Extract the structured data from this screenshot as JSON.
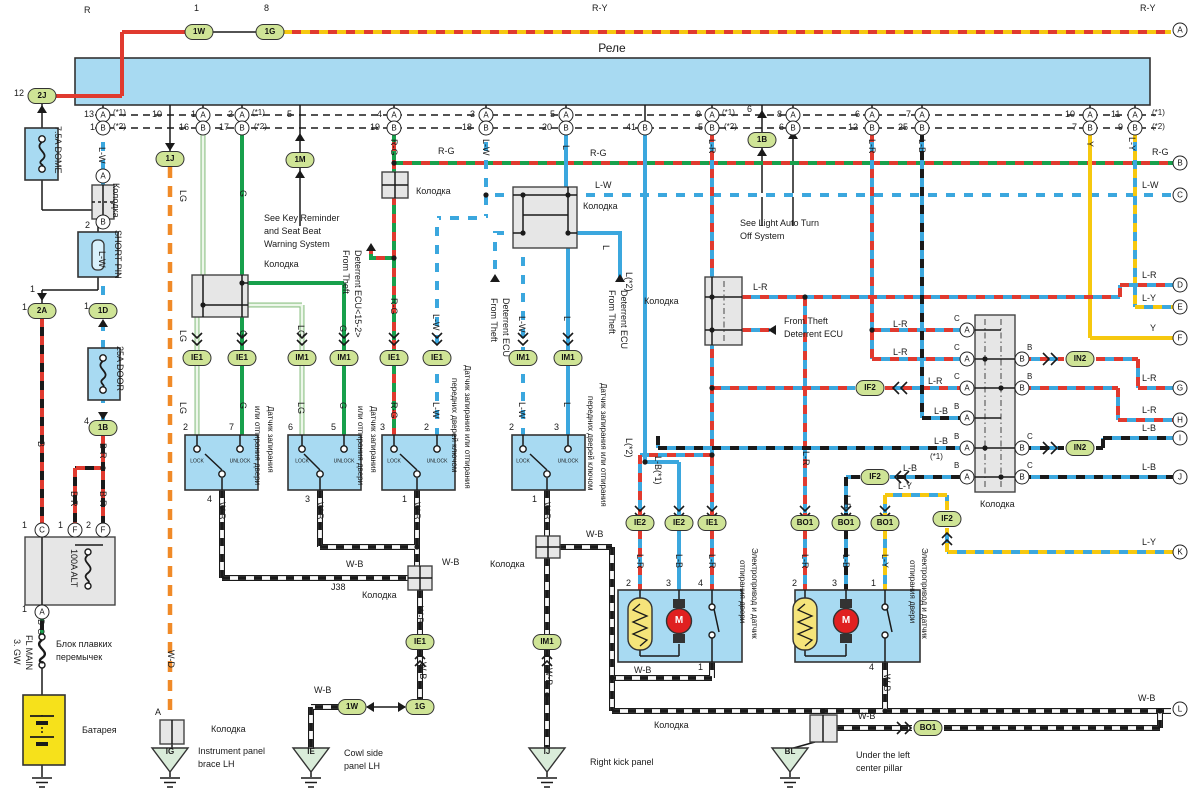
{
  "relay": {
    "label": "Реле"
  },
  "ovals": [
    [
      "2J",
      42,
      96
    ],
    [
      "1W",
      199,
      32
    ],
    [
      "1G",
      270,
      32
    ],
    [
      "1J",
      170,
      159
    ],
    [
      "1M",
      300,
      160
    ],
    [
      "1B",
      762,
      140
    ],
    [
      "2A",
      42,
      311
    ],
    [
      "1D",
      103,
      311
    ],
    [
      "1B",
      103,
      428
    ],
    [
      "IE1",
      197,
      358
    ],
    [
      "IE1",
      242,
      358
    ],
    [
      "IM1",
      302,
      358
    ],
    [
      "IM1",
      344,
      358
    ],
    [
      "IE1",
      394,
      358
    ],
    [
      "IE1",
      437,
      358
    ],
    [
      "IM1",
      523,
      358
    ],
    [
      "IM1",
      568,
      358
    ],
    [
      "IE2",
      640,
      523
    ],
    [
      "IE2",
      679,
      523
    ],
    [
      "IE1",
      712,
      523
    ],
    [
      "BO1",
      805,
      523
    ],
    [
      "BO1",
      846,
      523
    ],
    [
      "BO1",
      885,
      523
    ],
    [
      "IE1",
      420,
      642
    ],
    [
      "IM1",
      547,
      642
    ],
    [
      "1W",
      352,
      707
    ],
    [
      "1G",
      420,
      707
    ],
    [
      "BO1",
      928,
      728
    ],
    [
      "IN2",
      1080,
      359
    ],
    [
      "IN2",
      1080,
      448
    ],
    [
      "IF2",
      875,
      477
    ],
    [
      "IF2",
      947,
      519
    ],
    [
      "IF2",
      870,
      388
    ]
  ],
  "circles": [
    [
      "A",
      103,
      115
    ],
    [
      "A",
      203,
      115
    ],
    [
      "A",
      242,
      115
    ],
    [
      "A",
      394,
      115
    ],
    [
      "A",
      486,
      115
    ],
    [
      "A",
      566,
      115
    ],
    [
      "A",
      712,
      115
    ],
    [
      "A",
      793,
      115
    ],
    [
      "A",
      872,
      115
    ],
    [
      "A",
      922,
      115
    ],
    [
      "A",
      1090,
      115
    ],
    [
      "A",
      1135,
      115
    ],
    [
      "B",
      103,
      128
    ],
    [
      "B",
      203,
      128
    ],
    [
      "B",
      242,
      128
    ],
    [
      "B",
      394,
      128
    ],
    [
      "B",
      486,
      128
    ],
    [
      "B",
      566,
      128
    ],
    [
      "B",
      645,
      128
    ],
    [
      "B",
      712,
      128
    ],
    [
      "B",
      793,
      128
    ],
    [
      "B",
      872,
      128
    ],
    [
      "B",
      922,
      128
    ],
    [
      "B",
      1090,
      128
    ],
    [
      "B",
      1135,
      128
    ],
    [
      "A",
      103,
      176
    ],
    [
      "B",
      103,
      222
    ],
    [
      "C",
      42,
      530
    ],
    [
      "F",
      75,
      530
    ],
    [
      "F",
      103,
      530
    ],
    [
      "A",
      42,
      612
    ],
    [
      "A",
      967,
      330
    ],
    [
      "A",
      967,
      359
    ],
    [
      "A",
      967,
      388
    ],
    [
      "A",
      967,
      418
    ],
    [
      "A",
      967,
      448
    ],
    [
      "A",
      967,
      477
    ],
    [
      "B",
      1022,
      359
    ],
    [
      "B",
      1022,
      388
    ],
    [
      "B",
      1022,
      448
    ],
    [
      "B",
      1022,
      477
    ],
    [
      "A",
      1180,
      30
    ],
    [
      "B",
      1180,
      163
    ],
    [
      "C",
      1180,
      195
    ],
    [
      "D",
      1180,
      285
    ],
    [
      "E",
      1180,
      307
    ],
    [
      "F",
      1180,
      338
    ],
    [
      "G",
      1180,
      388
    ],
    [
      "H",
      1180,
      420
    ],
    [
      "I",
      1180,
      438
    ],
    [
      "J",
      1180,
      477
    ],
    [
      "K",
      1180,
      552
    ],
    [
      "L",
      1180,
      709
    ]
  ],
  "labels": [
    [
      "R",
      84,
      6
    ],
    [
      "1",
      194,
      4
    ],
    [
      "8",
      264,
      4
    ],
    [
      "R-Y",
      592,
      4
    ],
    [
      "R-Y",
      1140,
      4
    ],
    [
      "12",
      14,
      89
    ],
    [
      "(*1)",
      1152,
      109,
      0,
      8
    ],
    [
      "(*2)",
      1152,
      123,
      0,
      8
    ],
    [
      "13",
      84,
      110
    ],
    [
      "(*1)",
      113,
      109,
      0,
      8
    ],
    [
      "1",
      90,
      123
    ],
    [
      "(*2)",
      113,
      123,
      0,
      8
    ],
    [
      "10",
      152,
      110
    ],
    [
      "1",
      191,
      110
    ],
    [
      "16",
      179,
      123
    ],
    [
      "2",
      228,
      110
    ],
    [
      "(*1)",
      252,
      109,
      0,
      8
    ],
    [
      "17",
      219,
      123
    ],
    [
      "(*2)",
      254,
      123,
      0,
      8
    ],
    [
      "5",
      287,
      110
    ],
    [
      "4",
      377,
      110
    ],
    [
      "19",
      370,
      123
    ],
    [
      "3",
      470,
      110
    ],
    [
      "18",
      462,
      123
    ],
    [
      "5",
      550,
      110
    ],
    [
      "20",
      542,
      123
    ],
    [
      "41",
      626,
      123
    ],
    [
      "9",
      696,
      110
    ],
    [
      "(*1)",
      722,
      109,
      0,
      8
    ],
    [
      "5",
      698,
      123
    ],
    [
      "(*2)",
      724,
      123,
      0,
      8
    ],
    [
      "6",
      747,
      105
    ],
    [
      "8",
      777,
      110
    ],
    [
      "6",
      779,
      123
    ],
    [
      "6",
      855,
      110
    ],
    [
      "12",
      848,
      123
    ],
    [
      "7",
      906,
      110
    ],
    [
      "25",
      898,
      123
    ],
    [
      "10",
      1065,
      110
    ],
    [
      "7",
      1072,
      123
    ],
    [
      "11",
      1111,
      110
    ],
    [
      "9",
      1118,
      123
    ],
    [
      "7.5A DOME",
      62,
      126,
      1
    ],
    [
      "2",
      85,
      221
    ],
    [
      "SHORT PIN",
      122,
      230,
      1
    ],
    [
      "1",
      30,
      285
    ],
    [
      "1",
      22,
      303
    ],
    [
      "B",
      45,
      441,
      1
    ],
    [
      "L-W",
      106,
      147,
      1
    ],
    [
      "Колодка",
      120,
      183,
      1
    ],
    [
      "L-W",
      106,
      251,
      1
    ],
    [
      "1",
      84,
      302
    ],
    [
      "25A DOOR",
      124,
      346,
      1
    ],
    [
      "4",
      84,
      417
    ],
    [
      "B-R",
      107,
      443,
      1
    ],
    [
      "B-R",
      78,
      491,
      1
    ],
    [
      "B-R",
      107,
      491,
      1
    ],
    [
      "1",
      22,
      521
    ],
    [
      "1",
      58,
      521
    ],
    [
      "2",
      86,
      521
    ],
    [
      "1",
      22,
      605
    ],
    [
      "100A ALT",
      78,
      549,
      1
    ],
    [
      "B-G",
      45,
      619,
      1
    ],
    [
      "FL MAIN",
      33,
      635,
      1
    ],
    [
      "3. GW",
      21,
      639,
      1
    ],
    [
      "Блок плавких",
      56,
      640
    ],
    [
      "перемычек",
      56,
      653
    ],
    [
      "Батарея",
      82,
      726
    ],
    [
      "LG",
      187,
      190,
      1
    ],
    [
      "G",
      247,
      190,
      1
    ],
    [
      "R-G",
      398,
      139,
      1
    ],
    [
      "L-W",
      490,
      139,
      1
    ],
    [
      "L",
      570,
      145,
      1
    ],
    [
      "L(*2)",
      633,
      272,
      1
    ],
    [
      "L-R",
      716,
      139,
      1
    ],
    [
      "L-R",
      876,
      139,
      1
    ],
    [
      "L-B",
      926,
      139,
      1
    ],
    [
      "Y",
      1094,
      141,
      1
    ],
    [
      "L-Y",
      1136,
      137,
      1
    ],
    [
      "R-G",
      438,
      147
    ],
    [
      "R-G",
      590,
      149
    ],
    [
      "R-G",
      1152,
      148
    ],
    [
      "L-W",
      595,
      181
    ],
    [
      "L-W",
      1142,
      181
    ],
    [
      "L-R",
      753,
      283
    ],
    [
      "L-R",
      1142,
      271
    ],
    [
      "L-Y",
      1142,
      294
    ],
    [
      "Y",
      1150,
      324
    ],
    [
      "W-D",
      175,
      650,
      1
    ],
    [
      "Колодка",
      416,
      187
    ],
    [
      "Колодка",
      264,
      260
    ],
    [
      "Колодка",
      583,
      202
    ],
    [
      "Колодка",
      644,
      297
    ],
    [
      "Колодка",
      362,
      591
    ],
    [
      "Колодка",
      490,
      560
    ],
    [
      "Колодка",
      980,
      500
    ],
    [
      "Колодка",
      211,
      725
    ],
    [
      "Колодка",
      654,
      721
    ],
    [
      "See Key Reminder",
      264,
      214
    ],
    [
      "and Seat Beat",
      264,
      227
    ],
    [
      "Warning System",
      264,
      240
    ],
    [
      "See Light Auto Turn",
      740,
      219
    ],
    [
      "Off System",
      740,
      232
    ],
    [
      "From Theft",
      784,
      317
    ],
    [
      "Deterrent ECU",
      784,
      330
    ],
    [
      "From Theft",
      350,
      250,
      1
    ],
    [
      "Deterrent ECU<15-2>",
      362,
      250,
      1
    ],
    [
      "From Theft",
      498,
      298,
      1
    ],
    [
      "Deterrent ECU",
      510,
      298,
      1
    ],
    [
      "From Theft",
      616,
      290,
      1
    ],
    [
      "Deterrent ECU",
      628,
      290,
      1
    ],
    [
      "LG",
      187,
      330,
      1
    ],
    [
      "G",
      247,
      330,
      1
    ],
    [
      "LG",
      305,
      325,
      1
    ],
    [
      "G",
      347,
      325,
      1
    ],
    [
      "R-G",
      398,
      298,
      1
    ],
    [
      "L-W",
      440,
      314,
      1
    ],
    [
      "L-W",
      526,
      316,
      1
    ],
    [
      "L",
      571,
      316,
      1
    ],
    [
      "L",
      610,
      245,
      1
    ],
    [
      "L(*2)",
      633,
      438,
      1
    ],
    [
      "L-B(*1)",
      662,
      456,
      1
    ],
    [
      "L-R",
      810,
      451,
      1
    ],
    [
      "L-B",
      851,
      495,
      1
    ],
    [
      "LG",
      187,
      402,
      1
    ],
    [
      "G",
      247,
      402,
      1
    ],
    [
      "LG",
      305,
      402,
      1
    ],
    [
      "G",
      347,
      402,
      1
    ],
    [
      "R-G",
      398,
      402,
      1
    ],
    [
      "L-W",
      440,
      402,
      1
    ],
    [
      "L-W",
      526,
      402,
      1
    ],
    [
      "L",
      571,
      402,
      1
    ],
    [
      "L-R",
      644,
      554,
      1
    ],
    [
      "L-B",
      683,
      554,
      1
    ],
    [
      "L-R",
      716,
      554,
      1
    ],
    [
      "L-R",
      809,
      554,
      1
    ],
    [
      "L-B",
      850,
      554,
      1
    ],
    [
      "L-Y",
      889,
      554,
      1
    ],
    [
      "2",
      183,
      423
    ],
    [
      "7",
      229,
      423
    ],
    [
      "6",
      288,
      423
    ],
    [
      "5",
      331,
      423
    ],
    [
      "3",
      380,
      423
    ],
    [
      "2",
      424,
      423
    ],
    [
      "2",
      509,
      423
    ],
    [
      "3",
      554,
      423
    ],
    [
      "4",
      207,
      495
    ],
    [
      "3",
      305,
      495
    ],
    [
      "1",
      402,
      495
    ],
    [
      "1",
      532,
      495
    ],
    [
      "или отпирания двери",
      261,
      406,
      1,
      8
    ],
    [
      "Датчик запирания",
      274,
      406,
      1,
      8
    ],
    [
      "или отпирания двери",
      364,
      406,
      1,
      8
    ],
    [
      "Датчик запирания",
      377,
      406,
      1,
      8
    ],
    [
      "передних дверей ключом",
      458,
      378,
      1,
      8
    ],
    [
      "Датчик запирания или отпирания",
      471,
      365,
      1,
      8
    ],
    [
      "передних дверей ключом",
      594,
      396,
      1,
      8
    ],
    [
      "Датчик запирания или отпирания",
      607,
      383,
      1,
      8
    ],
    [
      "2",
      626,
      579
    ],
    [
      "3",
      666,
      579
    ],
    [
      "4",
      698,
      579
    ],
    [
      "1",
      698,
      663
    ],
    [
      "2",
      792,
      579
    ],
    [
      "3",
      832,
      579
    ],
    [
      "1",
      871,
      579
    ],
    [
      "4",
      869,
      663
    ],
    [
      "отпирания двери",
      746,
      560,
      1,
      8
    ],
    [
      "Электропривод и датчик",
      758,
      548,
      1,
      8
    ],
    [
      "отпирания двери",
      916,
      560,
      1,
      8
    ],
    [
      "Электропривод и датчик",
      928,
      548,
      1,
      8
    ],
    [
      "M",
      679,
      621,
      0,
      10,
      1,
      1,
      "#fff"
    ],
    [
      "M",
      846,
      621,
      0,
      10,
      1,
      1,
      "#fff"
    ],
    [
      "LOCK",
      197,
      462,
      0,
      5,
      1
    ],
    [
      "UNLOCK",
      240,
      462,
      0,
      5,
      1
    ],
    [
      "LOCK",
      302,
      462,
      0,
      5,
      1
    ],
    [
      "UNLOCK",
      344,
      462,
      0,
      5,
      1
    ],
    [
      "LOCK",
      394,
      462,
      0,
      5,
      1
    ],
    [
      "UNLOCK",
      437,
      462,
      0,
      5,
      1
    ],
    [
      "LOCK",
      523,
      462,
      0,
      5,
      1
    ],
    [
      "UNLOCK",
      568,
      462,
      0,
      5,
      1
    ],
    [
      "W-B",
      226,
      502,
      1
    ],
    [
      "W-B",
      324,
      502,
      1
    ],
    [
      "W-B",
      421,
      502,
      1
    ],
    [
      "W-B",
      551,
      502,
      1
    ],
    [
      "W-B",
      346,
      560
    ],
    [
      "J38",
      331,
      583
    ],
    [
      "W-B",
      442,
      558
    ],
    [
      "W-B",
      586,
      530
    ],
    [
      "W-B",
      424,
      606,
      1
    ],
    [
      "W-B",
      427,
      662,
      1
    ],
    [
      "W-B",
      553,
      668,
      1
    ],
    [
      "W-B",
      314,
      686
    ],
    [
      "W-B",
      634,
      666
    ],
    [
      "W-B",
      891,
      674,
      1
    ],
    [
      "W-B",
      858,
      712
    ],
    [
      "W-B",
      1138,
      694
    ],
    [
      "L-R",
      893,
      320
    ],
    [
      "L-R",
      893,
      348
    ],
    [
      "L-R",
      928,
      377
    ],
    [
      "L-B",
      934,
      407
    ],
    [
      "L-B",
      934,
      437
    ],
    [
      "(*1)",
      930,
      453,
      0,
      8
    ],
    [
      "L-B",
      903,
      464
    ],
    [
      "L-Y",
      898,
      482
    ],
    [
      "L-R",
      1142,
      374
    ],
    [
      "L-R",
      1142,
      406
    ],
    [
      "L-B",
      1142,
      424
    ],
    [
      "L-B",
      1142,
      463
    ],
    [
      "L-Y",
      1142,
      538
    ],
    [
      "C",
      954,
      315,
      0,
      8
    ],
    [
      "C",
      954,
      344,
      0,
      8
    ],
    [
      "C",
      954,
      373,
      0,
      8
    ],
    [
      "B",
      954,
      403,
      0,
      8
    ],
    [
      "B",
      954,
      433,
      0,
      8
    ],
    [
      "B",
      954,
      462,
      0,
      8
    ],
    [
      "B",
      1027,
      344,
      0,
      8
    ],
    [
      "B",
      1027,
      373,
      0,
      8
    ],
    [
      "C",
      1027,
      433,
      0,
      8
    ],
    [
      "C",
      1027,
      462,
      0,
      8
    ],
    [
      "IG",
      170,
      752,
      0,
      8,
      1,
      1
    ],
    [
      "IE",
      311,
      752,
      0,
      8,
      1,
      1
    ],
    [
      "IJ",
      547,
      752,
      0,
      8,
      1,
      1
    ],
    [
      "BL",
      790,
      752,
      0,
      8,
      1,
      1
    ],
    [
      "A",
      155,
      708
    ],
    [
      "Instrument panel",
      198,
      747
    ],
    [
      "brace LH",
      198,
      760
    ],
    [
      "Cowl side",
      344,
      749
    ],
    [
      "panel LH",
      344,
      762
    ],
    [
      "Right kick panel",
      590,
      758
    ],
    [
      "Under the left",
      856,
      751
    ],
    [
      "center pillar",
      856,
      764
    ]
  ]
}
